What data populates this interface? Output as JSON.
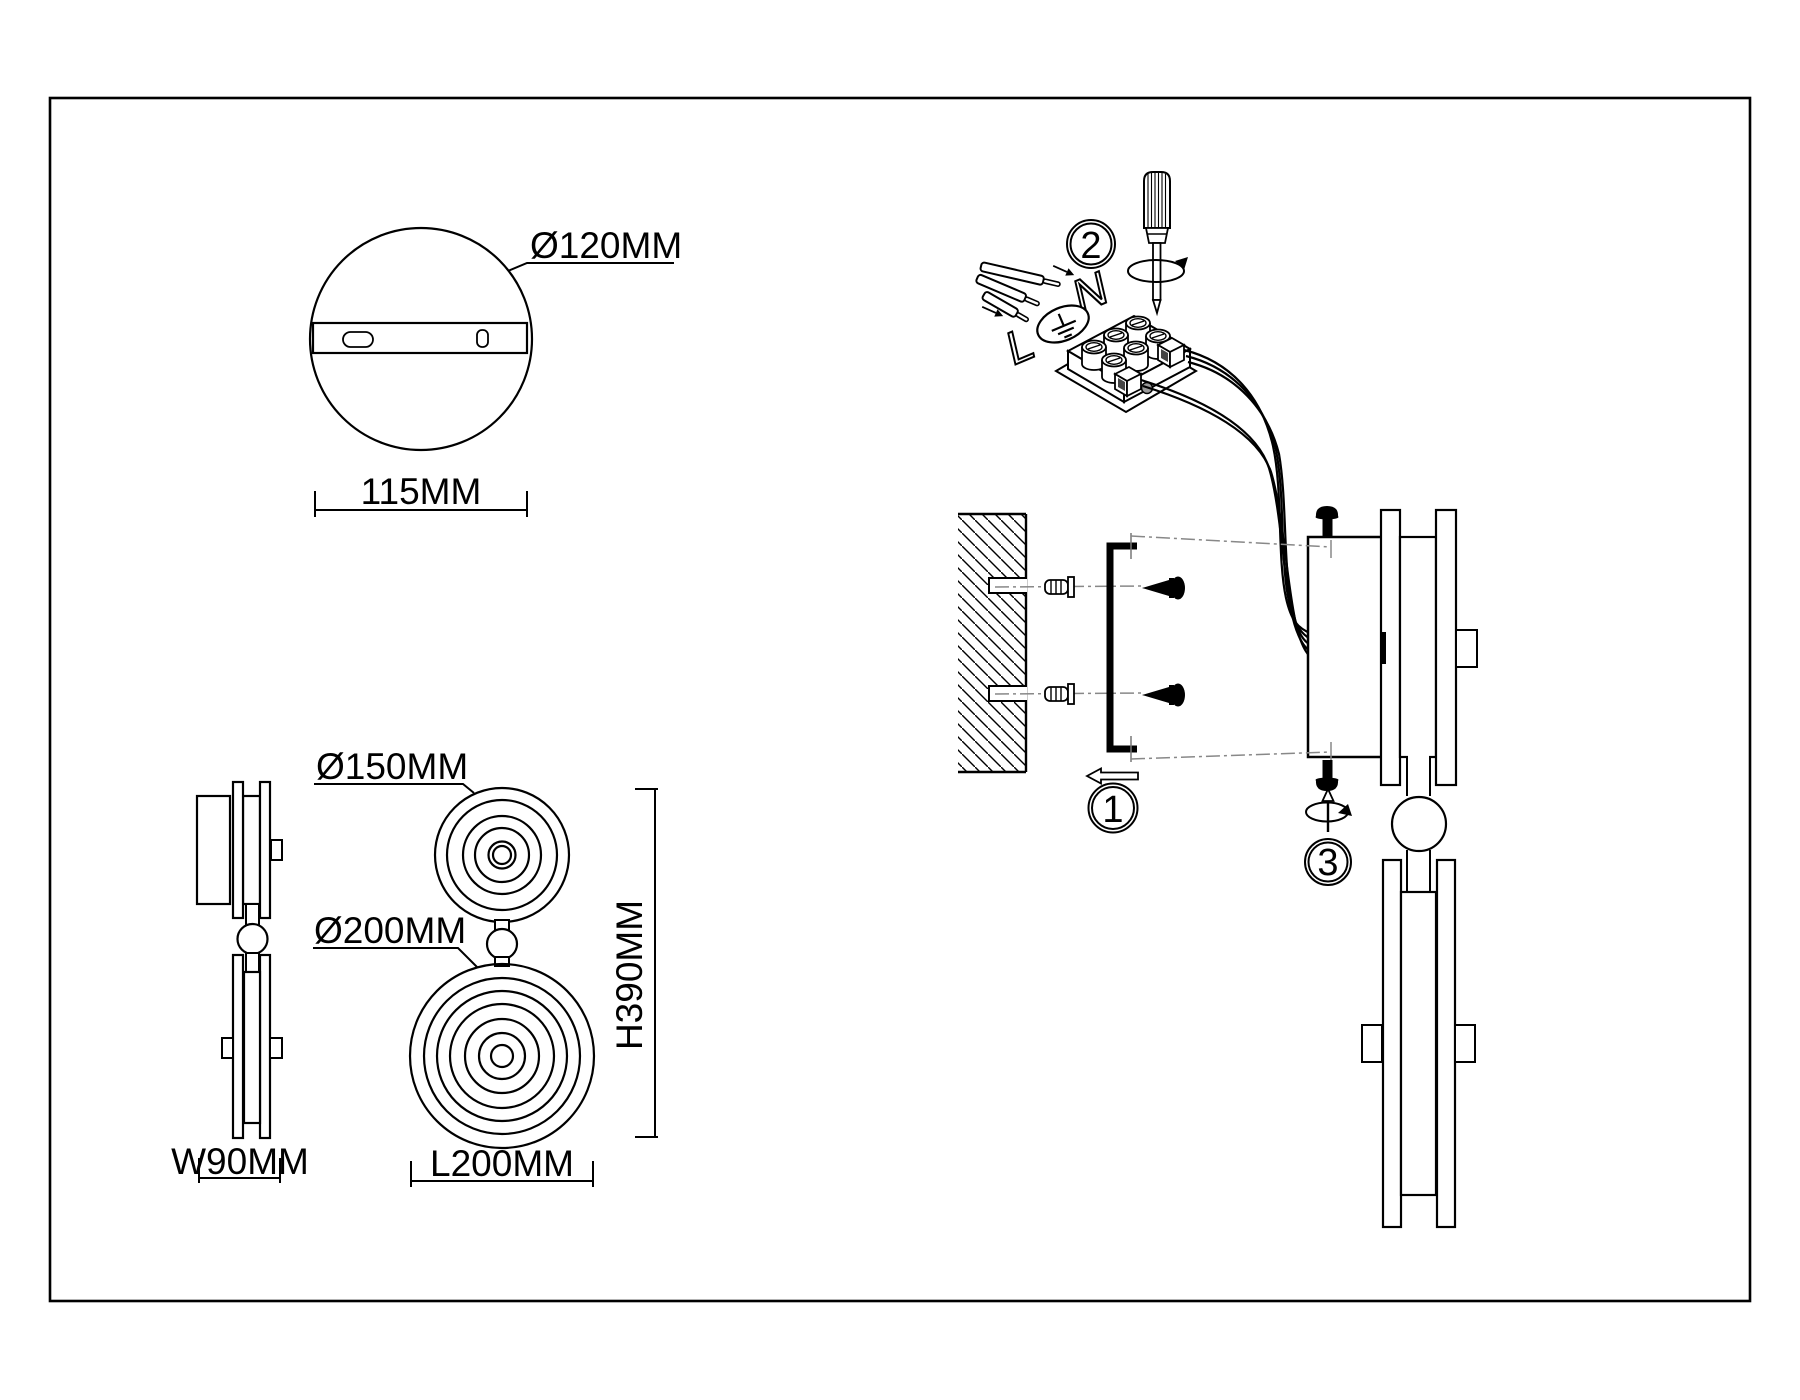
{
  "drawing": {
    "background": "#ffffff",
    "line_color": "#000000",
    "centerline_color": "#888888",
    "canopy_view": {
      "diameter_label": "Ø120MM",
      "width_label": "115MM"
    },
    "side_view": {
      "width_label": "W90MM"
    },
    "front_view": {
      "top_shade_diameter_label": "Ø150MM",
      "bottom_shade_diameter_label": "Ø200MM",
      "height_label": "H390MM",
      "length_label": "L200MM"
    },
    "installation_steps": {
      "step1": "1",
      "step2": "2",
      "step3": "3"
    },
    "terminal": {
      "live_label": "L",
      "neutral_label": "N",
      "ground_icon": "earth-ground-symbol"
    }
  }
}
